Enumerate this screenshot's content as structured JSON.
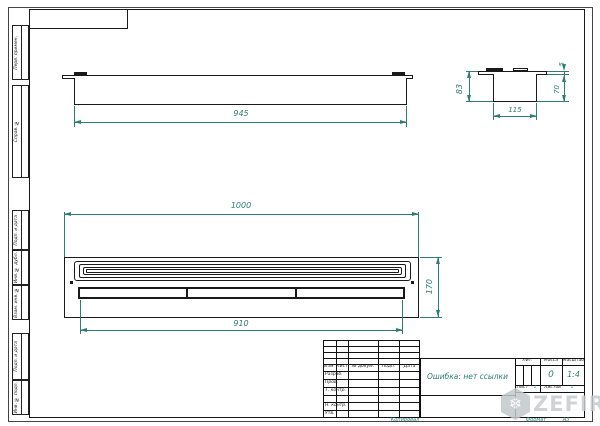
{
  "frame": {
    "margin_labels": [
      "Перв. примен.",
      "Справ. №",
      "Подп. и дата",
      "Инв. № дубл.",
      "Взам. инв. №",
      "Подп. и дата",
      "Инв. № подл."
    ]
  },
  "dims": {
    "top_view_length": "945",
    "side_height": "83",
    "side_flange": "5",
    "side_body": "70",
    "side_width": "115",
    "front_width": "1000",
    "front_height": "170",
    "front_slot": "910"
  },
  "title_block": {
    "cols": [
      "Изм.",
      "Лист",
      "№ докум.",
      "Подп.",
      "Дата"
    ],
    "rows": [
      "Разраб.",
      "Пров.",
      "Т. контр.",
      "",
      "Н. контр.",
      "Утв."
    ],
    "doc_name": "Ошибка: нет ссылки",
    "lit_label": "Лит.",
    "mass_label": "Масса",
    "scale_label": "Масштаб",
    "mass_value": "0",
    "scale_value": "1:4",
    "sheet_label": "Лист",
    "sheet_value": "1",
    "sheets_label": "Листов",
    "sheets_value": "1",
    "copied_label": "Копировал",
    "format_label": "Формат",
    "format_value": "А3"
  },
  "watermark": {
    "text": "ZEFIRE",
    "icon_glyph": "❄"
  },
  "colors": {
    "dimension": "#2e7d73",
    "line": "#1a1a1a",
    "watermark": "#c8ccce"
  }
}
